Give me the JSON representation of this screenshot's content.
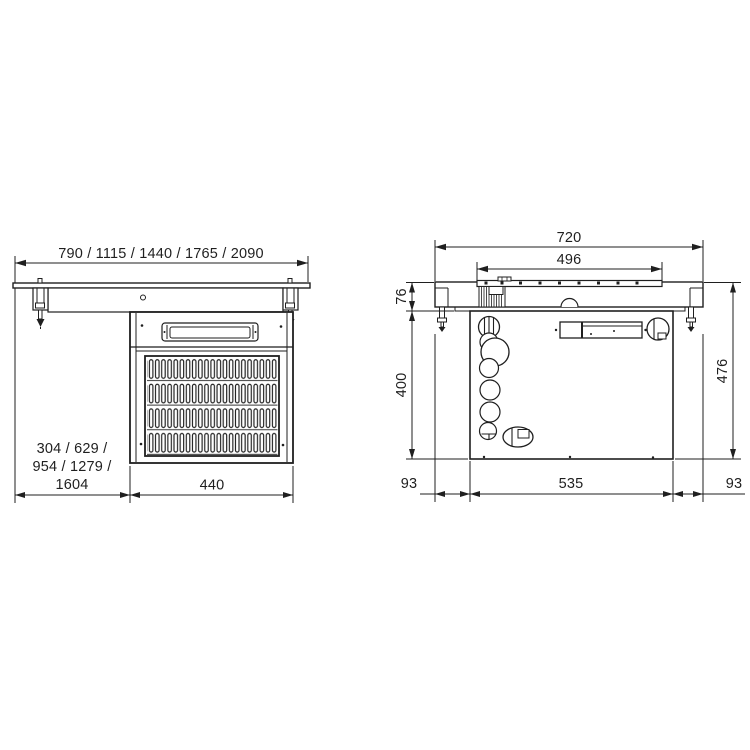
{
  "drawing": {
    "kind": "technical dimension drawing, drop-in refrigerated unit",
    "colors": {
      "line": "#1f1f1f",
      "background": "#ffffff"
    }
  },
  "front_view": {
    "label": "front elevation",
    "dims": {
      "top_widths": "790 / 1115 / 1440 / 1765 / 2090",
      "cutout_line1": "304 / 629 /",
      "cutout_line2": "954 / 1279 /",
      "cutout_line3": "1604",
      "housing_width": "440"
    }
  },
  "side_view": {
    "label": "side elevation",
    "dims": {
      "overall_depth": "720",
      "cutout_depth": "496",
      "counter_thickness": "76",
      "housing_height": "400",
      "overall_height": "476",
      "front_offset": "93",
      "housing_depth": "535",
      "rear_offset": "93"
    }
  }
}
